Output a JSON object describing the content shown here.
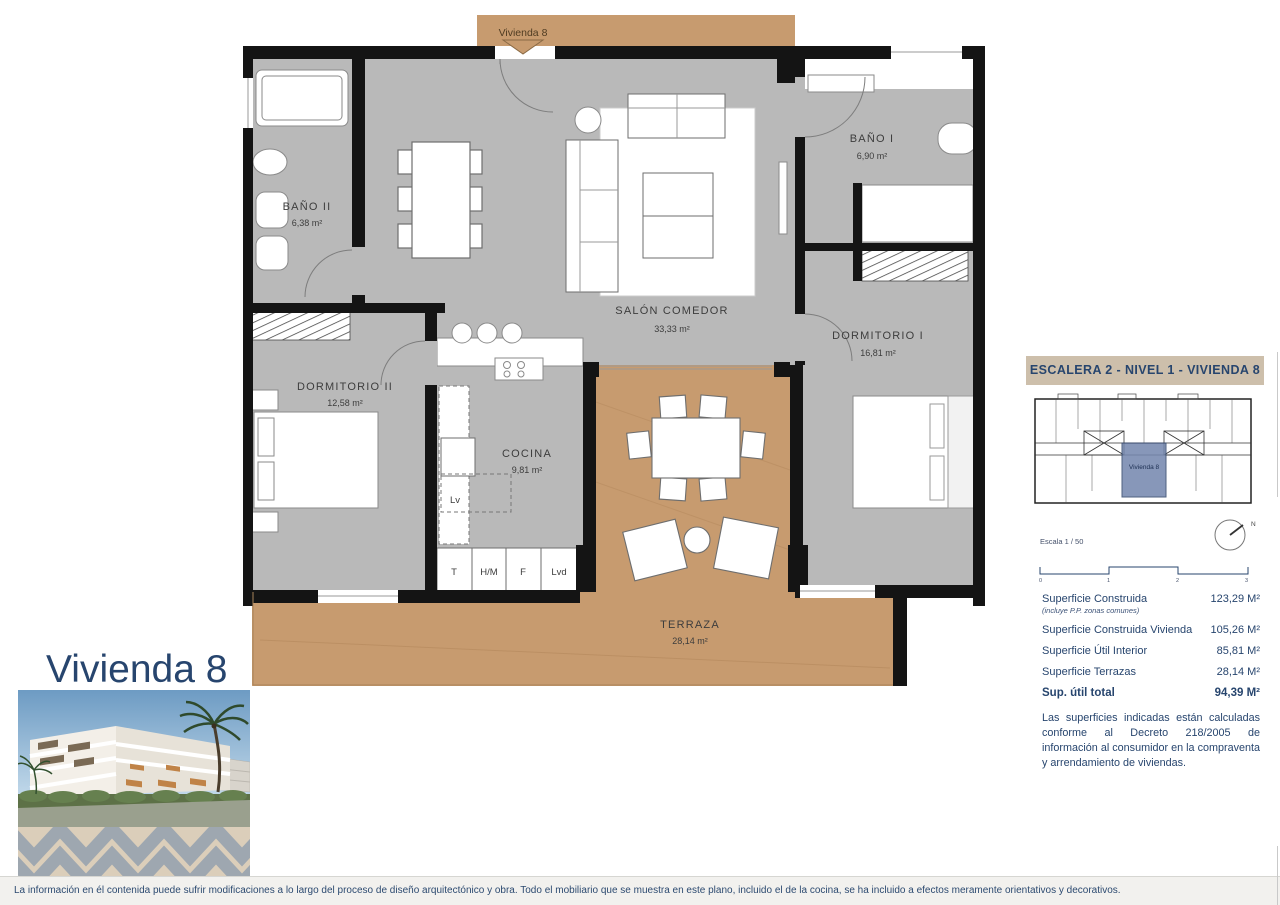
{
  "page": {
    "title": "Vivienda 8"
  },
  "plan": {
    "entry_label": "Vivienda 8",
    "rooms": {
      "bano2": {
        "name": "BAÑO II",
        "area": "6,38 m²"
      },
      "dormitorio2": {
        "name": "DORMITORIO II",
        "area": "12,58 m²"
      },
      "cocina": {
        "name": "COCINA",
        "area": "9,81 m²"
      },
      "salon": {
        "name": "SALÓN COMEDOR",
        "area": "33,33 m²"
      },
      "bano1": {
        "name": "BAÑO I",
        "area": "6,90 m²"
      },
      "dormitorio1": {
        "name": "DORMITORIO I",
        "area": "16,81 m²"
      },
      "terraza": {
        "name": "TERRAZA",
        "area": "28,14 m²"
      }
    },
    "appliances": {
      "t": "T",
      "hm": "H/M",
      "f": "F",
      "lvd": "Lvd",
      "lv": "Lv"
    }
  },
  "sidebar": {
    "header": "ESCALERA 2 - NIVEL 1 - VIVIENDA 8",
    "keyplan_label": "Vivienda 8",
    "scale_text": "Escala 1 / 50",
    "compass_n": "N",
    "scalebar": {
      "t0": "0",
      "t1": "1",
      "t2": "2",
      "t3": "3"
    },
    "surfaces": {
      "row1_label": "Superficie Construida",
      "row1_sub": "(incluye P.P. zonas comunes)",
      "row1_value": "123,29 M²",
      "row2_label": "Superficie Construida Vivienda",
      "row2_value": "105,26 M²",
      "row3_label": "Superficie Útil Interior",
      "row3_value": "85,81 M²",
      "row4_label": "Superficie Terrazas",
      "row4_value": "28,14 M²",
      "total_label": "Sup. útil total",
      "total_value": "94,39 M²"
    },
    "note": "Las superficies indicadas están calculadas conforme al Decreto 218/2005 de información al consumidor en la compraventa y arrendamiento de viviendas."
  },
  "footer": {
    "disclaimer": "La información en él contenida puede sufrir modificaciones a lo largo del proceso de diseño arquitectónico y obra. Todo el mobiliario que se muestra en este plano, incluido el de la cocina, se ha incluido a efectos meramente orientativos y decorativos."
  },
  "colors": {
    "accent_navy": "#27456e",
    "wall_black": "#141414",
    "floor_gray": "#b9b9b9",
    "deck_tan": "#c79b6f",
    "header_beige": "#cdbfab",
    "highlight_blue": "#7386ad"
  }
}
